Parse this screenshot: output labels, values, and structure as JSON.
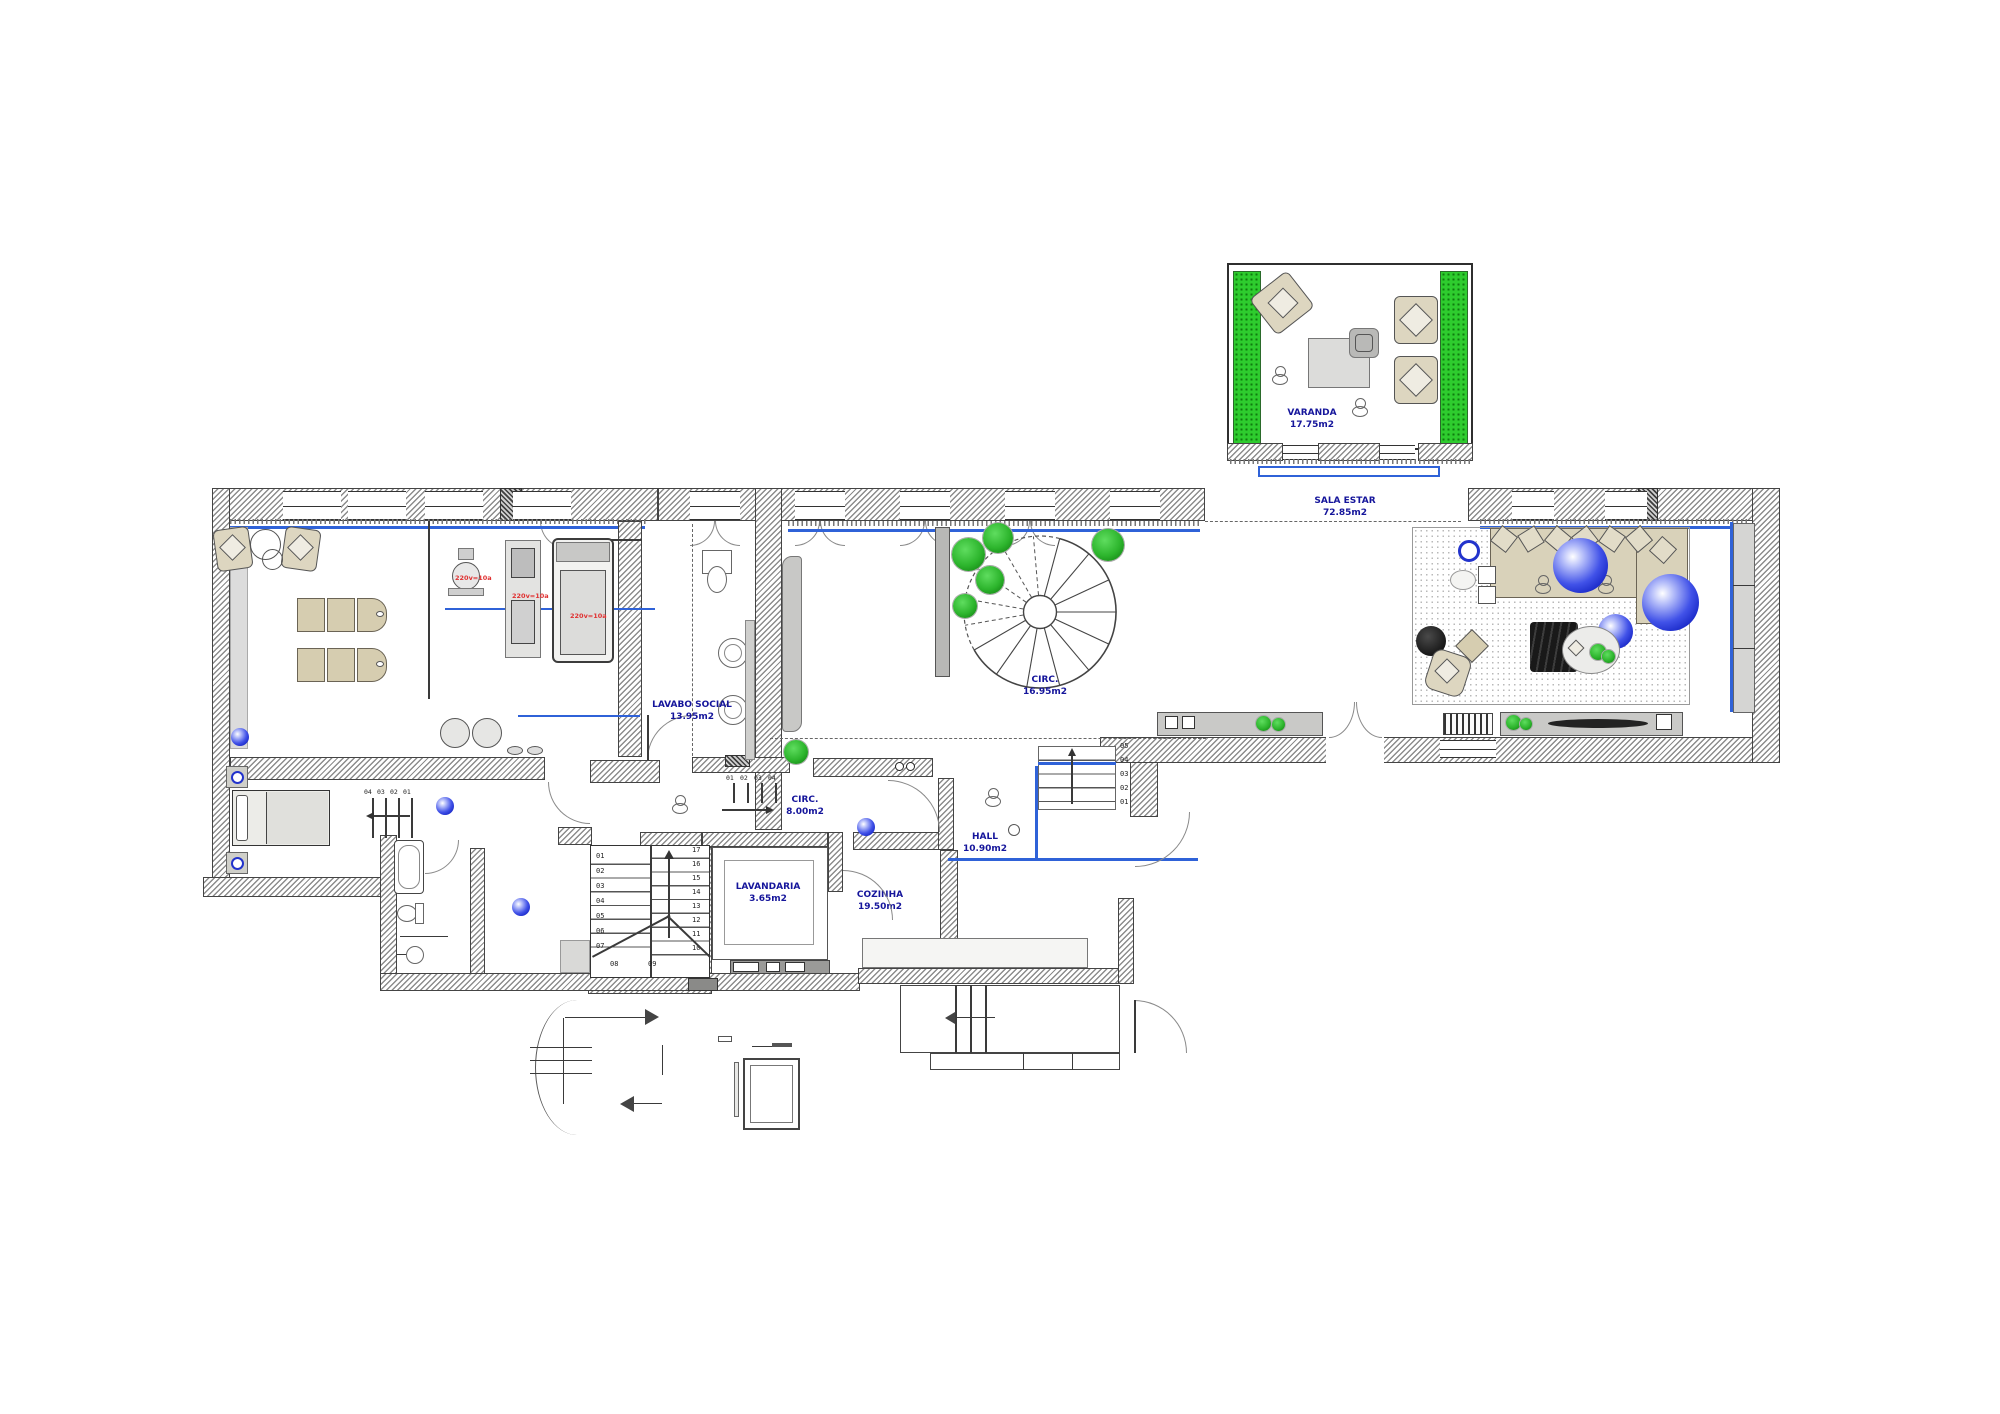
{
  "plan": {
    "rooms": [
      {
        "name": "VARANDA",
        "area": "17.75m2"
      },
      {
        "name": "SALA ESTAR",
        "area": "72.85m2"
      },
      {
        "name": "CIRC.",
        "area": "16.95m2"
      },
      {
        "name": "LAVABO SOCIAL",
        "area": "13.95m2"
      },
      {
        "name": "CIRC.",
        "area": "8.00m2"
      },
      {
        "name": "HALL",
        "area": "10.90m2"
      },
      {
        "name": "LAVANDARIA",
        "area": "3.65m2"
      },
      {
        "name": "COZINHA",
        "area": "19.50m2"
      }
    ],
    "equipment_labels": [
      {
        "text": "220v=10a"
      },
      {
        "text": "220v=10a"
      },
      {
        "text": "220v=10a"
      }
    ],
    "stairs": {
      "main": {
        "left": [
          "01",
          "02",
          "03",
          "04",
          "05",
          "06",
          "07"
        ],
        "right": [
          "17",
          "16",
          "15",
          "14",
          "13",
          "12",
          "11",
          "10"
        ],
        "bottom": [
          "08",
          "09"
        ]
      },
      "bedroom": [
        "04",
        "03",
        "02",
        "01"
      ],
      "corridor": [
        "01",
        "02",
        "03",
        "04"
      ],
      "hall": [
        "05",
        "04",
        "03",
        "02",
        "01"
      ]
    },
    "colors": {
      "label_blue": "#15159b",
      "glass_blue": "#2f62d8",
      "plant_green": "#2db52d",
      "equipment_red": "#e03232",
      "wall_hatch_gray": "#8c8c8c",
      "furniture_beige": "#d6cdb0",
      "sphere_blue": "#101fc0"
    }
  }
}
